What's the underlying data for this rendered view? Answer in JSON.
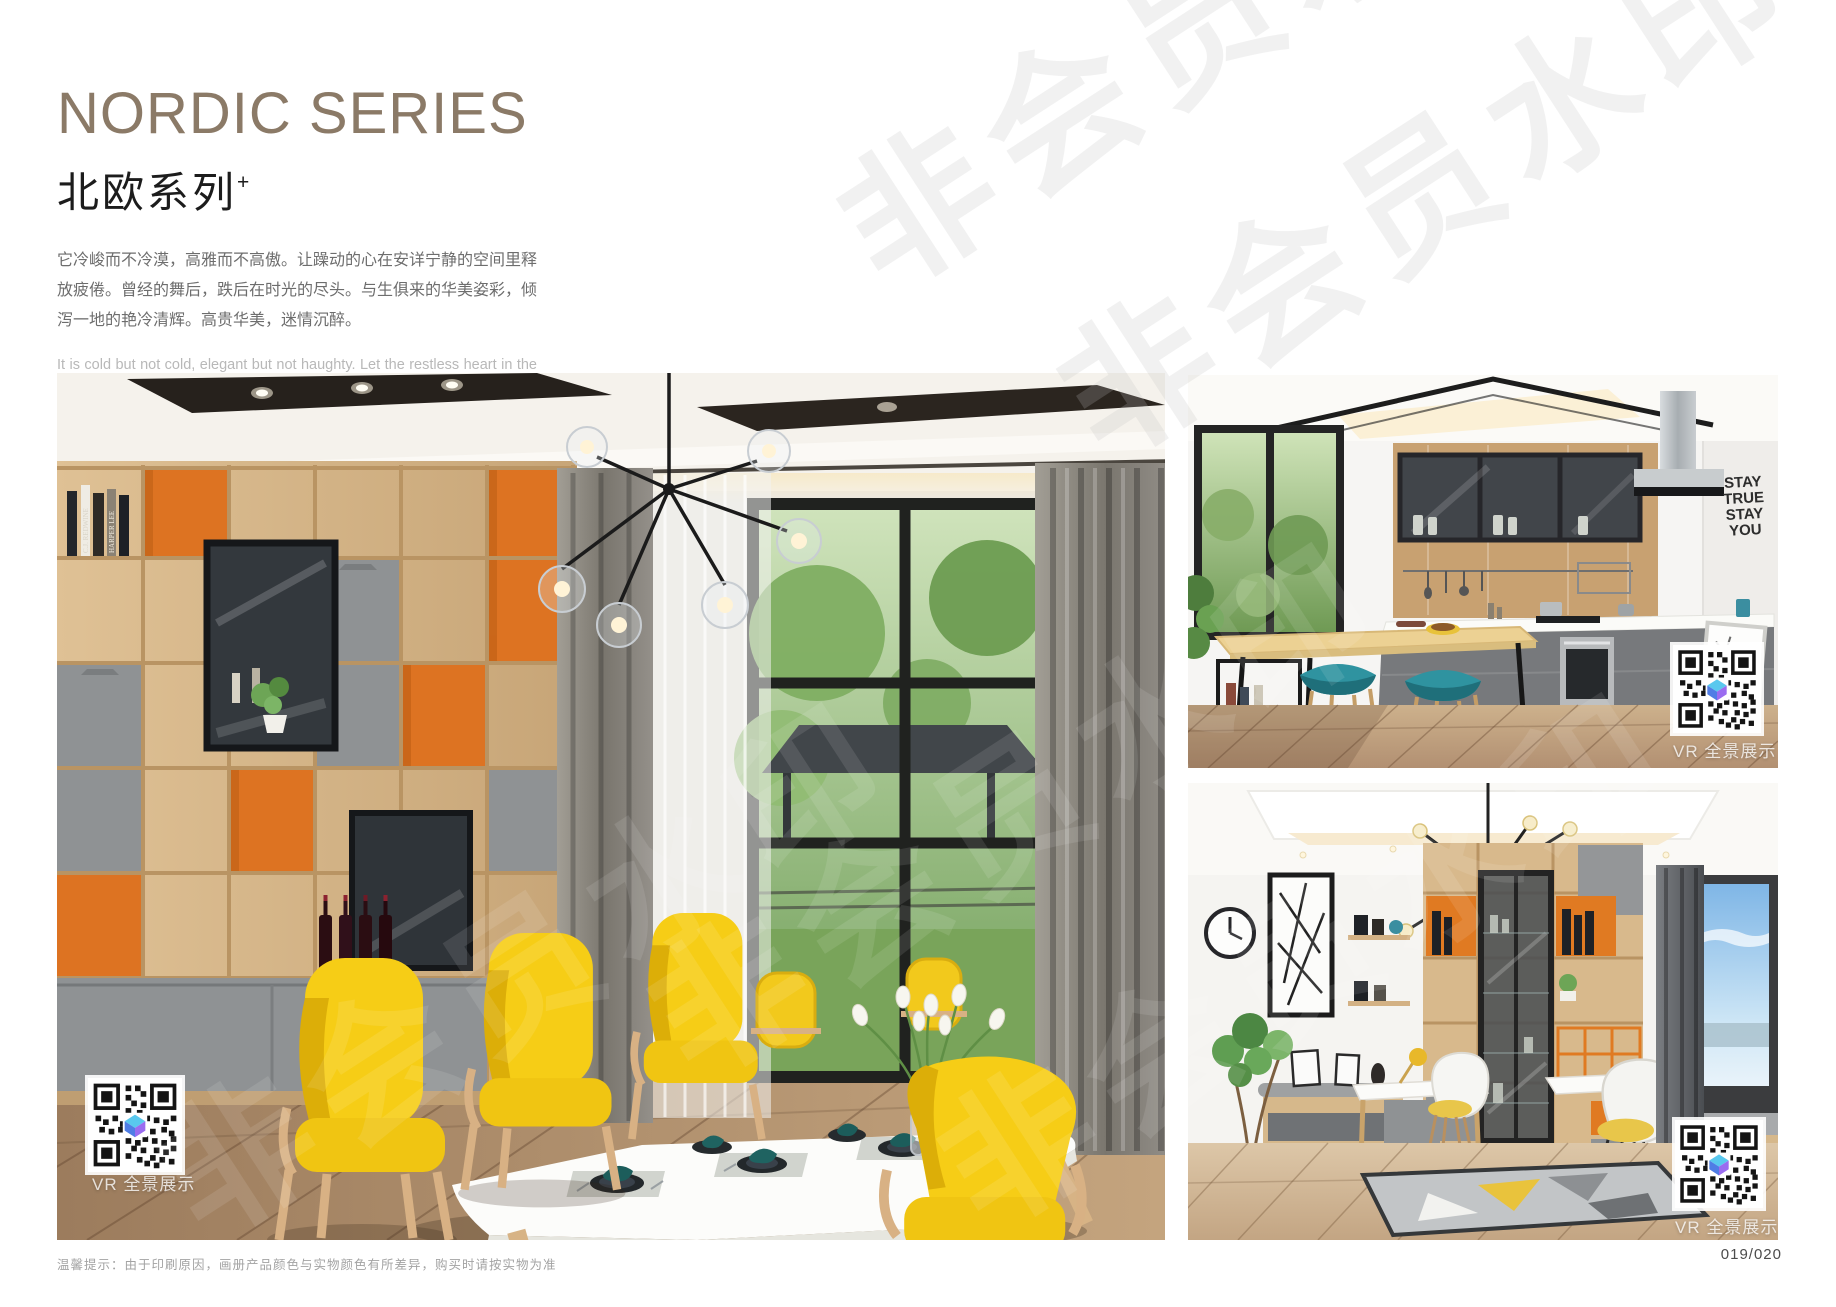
{
  "page": {
    "width": 1836,
    "height": 1307,
    "background": "#ffffff"
  },
  "header": {
    "title": "NORDIC SERIES",
    "title_color": "#8b7a67",
    "subtitle_cn": "北欧系列",
    "subtitle_sup": "+",
    "paragraph_cn": "它冷峻而不冷漠，高雅而不高傲。让躁动的心在安详宁静的空间里释放疲倦。曾经的舞后，跌后在时光的尽头。与生俱来的华美姿彩，倾泻一地的艳冷清辉。高贵华美，迷情沉醉。",
    "paragraph_en": "It is cold but not cold, elegant but not haughty. Let the restless heart in the space of peace and tranquility release fatigue. Once the Queen of Dance, fall in the end of time. The natural beauty of the beautiful, pouring a land of cold and pure brilliance. Noble, beautiful, enchanted."
  },
  "watermark": {
    "text": "非会员水印"
  },
  "photos": {
    "main": {
      "name": "dining-room",
      "vr_label": "VR 全景展示",
      "book_spines": [
        "C.J. REDWINE",
        "HARPER LEE"
      ]
    },
    "kitchen": {
      "name": "kitchen",
      "vr_label": "VR 全景展示",
      "wall_text": [
        "STAY",
        "TRUE",
        "STAY",
        "YOU"
      ]
    },
    "study": {
      "name": "study",
      "vr_label": "VR 全景展示"
    }
  },
  "footer": {
    "tip": "温馨提示：由于印刷原因，画册产品颜色与实物颜色有所差异，购买时请按实物为准",
    "page_number": "019/020"
  },
  "colors": {
    "accent_orange": "#dd7322",
    "chair_yellow": "#f6cd16",
    "stool_teal": "#2f93a0",
    "wood_oak": "#d9ba8d",
    "cabinet_gray": "#8f9294"
  }
}
